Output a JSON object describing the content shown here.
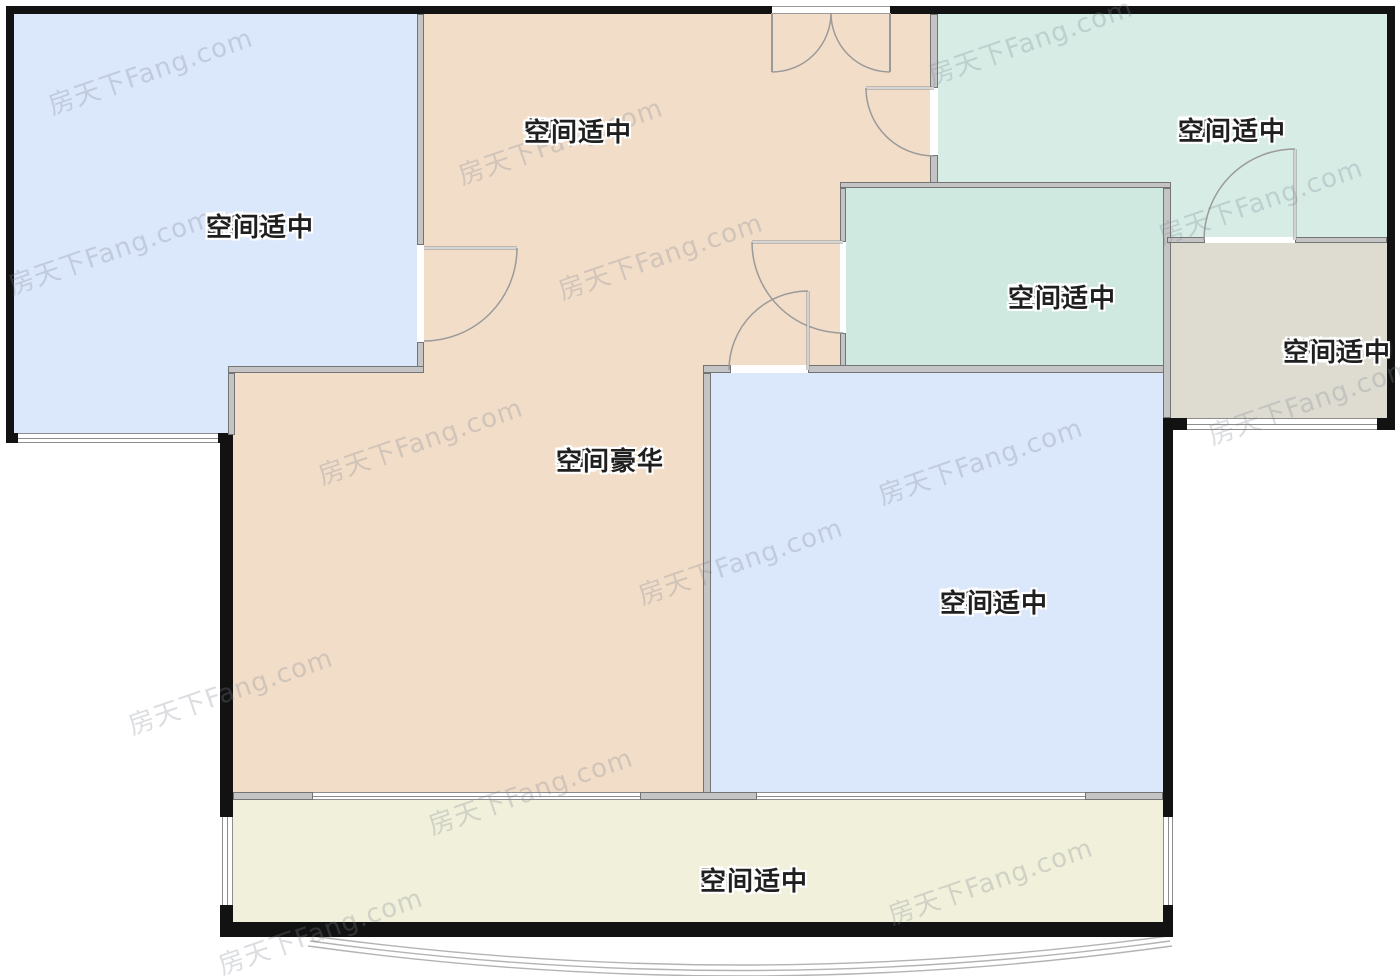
{
  "watermark": {
    "text": "房天下Fang.com"
  },
  "rooms": [
    {
      "id": "bedroom-b",
      "name": "卧室B",
      "condition": "空间适中"
    },
    {
      "id": "dining",
      "name": "餐厅",
      "condition": "空间适中"
    },
    {
      "id": "kitchen",
      "name": "厨房",
      "condition": "空间适中"
    },
    {
      "id": "bathroom",
      "name": "卫生间",
      "condition": "空间适中"
    },
    {
      "id": "storage",
      "name": "储物间",
      "condition": "空间适中"
    },
    {
      "id": "living",
      "name": "客厅",
      "condition": "空间豪华"
    },
    {
      "id": "bedroom-a",
      "name": "卧室A",
      "condition": "空间适中"
    },
    {
      "id": "balcony",
      "name": "阳台",
      "condition": "空间适中"
    }
  ],
  "colors": {
    "bedroom_fill": "#dbe7fa",
    "living_dining_fill": "#f2ddc8",
    "kitchen_fill": "#d6ece5",
    "bathroom_fill": "#cfe8e0",
    "storage_fill": "#dedcd0",
    "balcony_fill": "#f1f0da",
    "exterior_wall": "#121212",
    "interior_wall": "#c4c4c4",
    "label_text": "#1f1f1f"
  }
}
